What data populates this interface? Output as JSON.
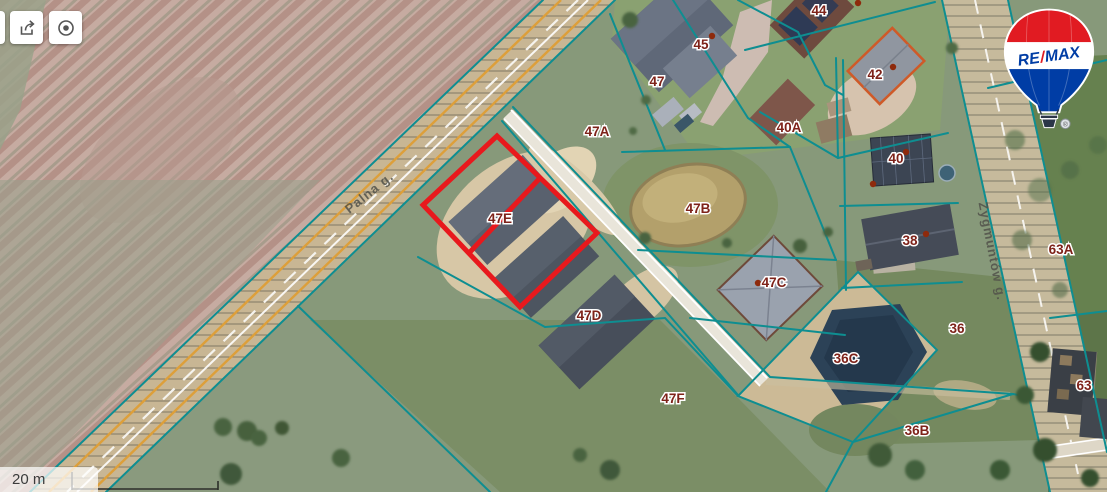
{
  "toolbar": {
    "buttons": [
      {
        "icon": "share-icon"
      },
      {
        "icon": "locate-icon"
      }
    ]
  },
  "scale_bar": {
    "label": "20 m"
  },
  "logo": {
    "re": "RE",
    "slash": "/",
    "max": "MAX"
  },
  "map": {
    "street_labels": [
      "Palna g.",
      "Zygmuntów g."
    ],
    "parcel_labels": [
      "45",
      "47",
      "47A",
      "44",
      "42",
      "40A",
      "40",
      "38",
      "47B",
      "47C",
      "47E",
      "47D",
      "47F",
      "36C",
      "36",
      "36B",
      "63A",
      "63"
    ],
    "highlight_color": "#e8191d",
    "boundary_color": "#0e8e91",
    "label_color": "#7e2219",
    "road_hatch_fill": "#c8b694"
  }
}
